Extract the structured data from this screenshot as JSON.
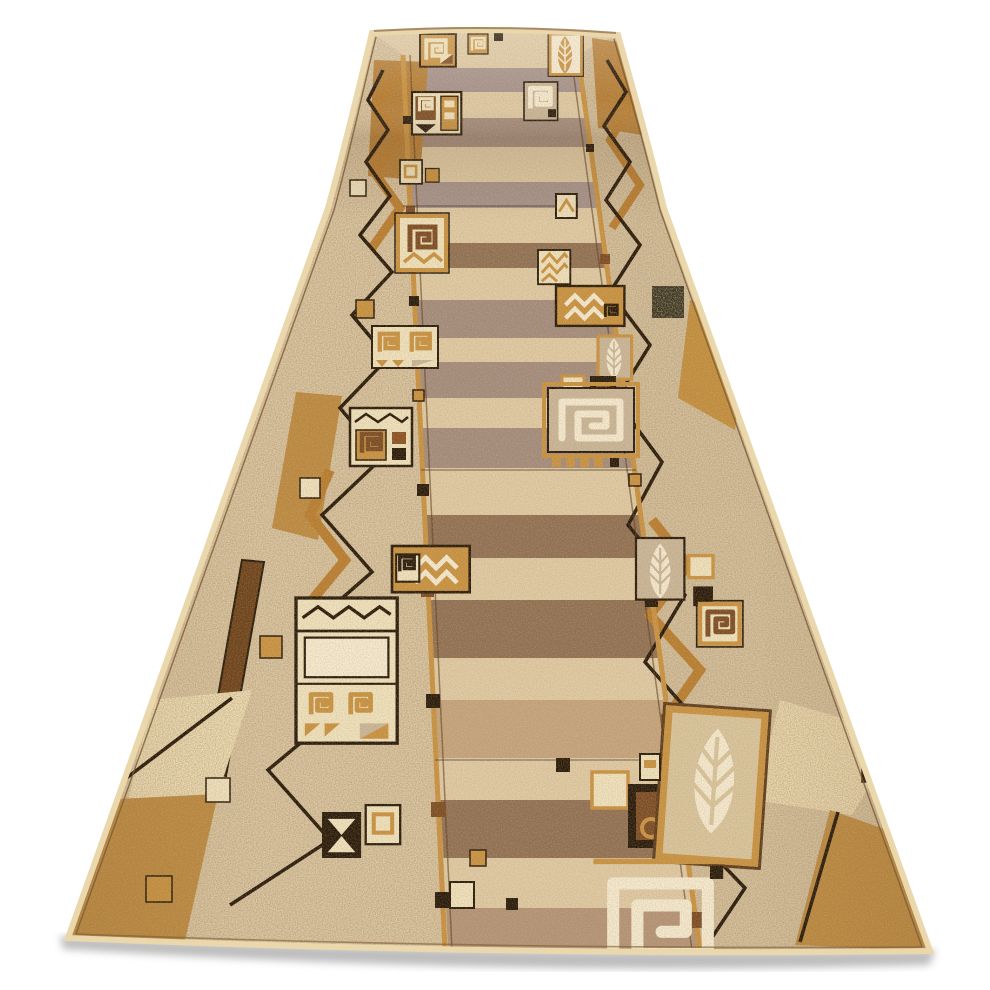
{
  "meta": {
    "description": "Product photo of a long beige carpet runner (hallway rug) shown in perspective on a plain white background; the far end of the runner is curled over at the top, the near end is wide at the bottom with a soft gray floor shadow. No text appears in the image.",
    "background_color": "#ffffff"
  },
  "product": {
    "type": "carpet runner rug",
    "orientation": "vertical runner receding toward the top, rolled over at the far end",
    "pattern_style": "modern patchwork / abstract geometric border design",
    "pattern_motifs": [
      "rectangular spirals in squares",
      "leaf in rectangular frame",
      "zigzag chevron lines",
      "nested squares and small blocks",
      "hourglass / bowtie triangles",
      "speckled caramel border patches",
      "horizontal streaked beige field",
      "gold guide lines with small squares",
      "dark brown zigzag border lines",
      "cream binding edge"
    ],
    "colors": {
      "bg": "#ffffff",
      "base": "#cbb394",
      "field_light": "#dfcaa4",
      "field_taupe": "#a28b7c",
      "field_brown": "#8f6f52",
      "field_mauve": "#a5928c",
      "cream": "#efe2bd",
      "cream_bright": "#f5ead0",
      "gold": "#c8913f",
      "caramel": "#b87c2e",
      "brown_mid": "#7a4a22",
      "brown_deep": "#5a3a1a",
      "dark": "#241607",
      "rust": "#8a4f1f",
      "tan_panel": "#c9b598",
      "edge": "#ead8ac",
      "olive": "#3a3420",
      "shadow": "#9a9a9a"
    }
  }
}
